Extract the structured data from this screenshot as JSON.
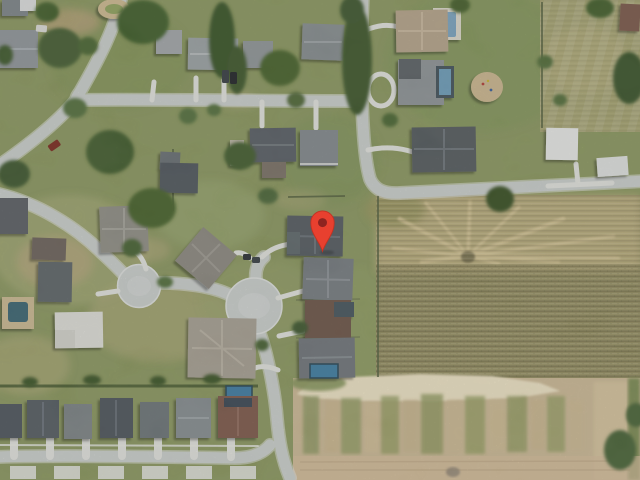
{
  "map": {
    "view_type": "satellite",
    "marker": {
      "x": 322,
      "y": 251,
      "color": "#e8402f",
      "inner_color": "#8e2420",
      "outline_color": "#c23222"
    },
    "palette": {
      "grass": "#8a9660",
      "road": "#c8ccca",
      "road_edge": "#dadddb",
      "driveway": "#dedfda",
      "field": "#a09a6c",
      "field_dry": "#c0b183",
      "dirt": "#c9b795",
      "sand": "#e9dfc2",
      "tree": "#46602f",
      "roof_dark": "#555c62",
      "roof_light": "#9aa0a3",
      "pool": "#4d86a8"
    }
  }
}
